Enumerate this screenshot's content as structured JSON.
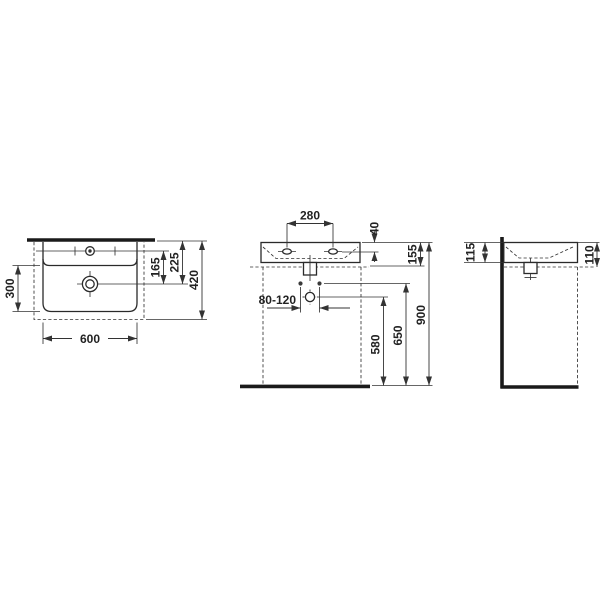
{
  "ink_color": "#2a2a2a",
  "background_color": "#ffffff",
  "views": {
    "top": {
      "width": "600",
      "bowl_depth": "300",
      "total_depth": "420",
      "back_edge_to_drain": "225",
      "tap_axis_to_drain": "165"
    },
    "front": {
      "tap_hole_spacing": "280",
      "rim_to_tap_axis": "40",
      "basin_height": "155",
      "fixing_hole_spacing": "80-120",
      "drain_connection_height": "580",
      "fixing_bolt_height": "650",
      "installation_height": "900"
    },
    "side": {
      "height_at_wall": "115",
      "height_at_front": "110"
    }
  }
}
